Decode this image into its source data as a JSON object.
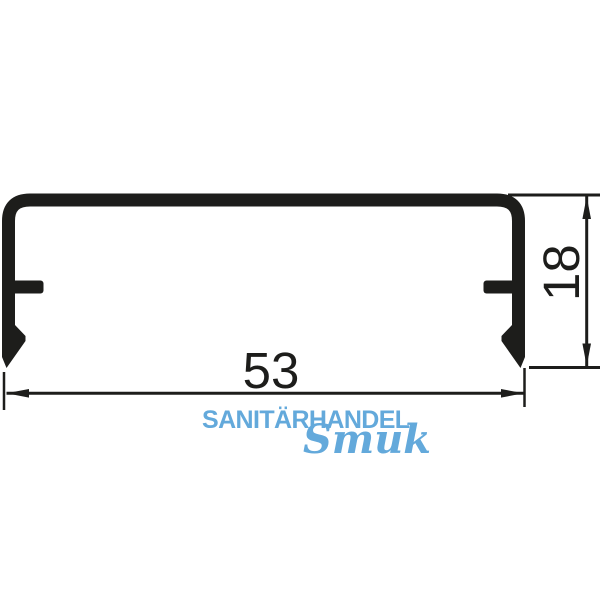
{
  "diagram": {
    "type": "profile-cross-section-drawing",
    "dimensions": {
      "width_value": "53",
      "height_value": "18"
    }
  },
  "watermark": {
    "line1": "SANITÄRHANDEL",
    "line2": "Smuk"
  },
  "colors": {
    "ink": "#1d1d1b",
    "watermark_blue": "#63a9db",
    "background": "#ffffff"
  }
}
